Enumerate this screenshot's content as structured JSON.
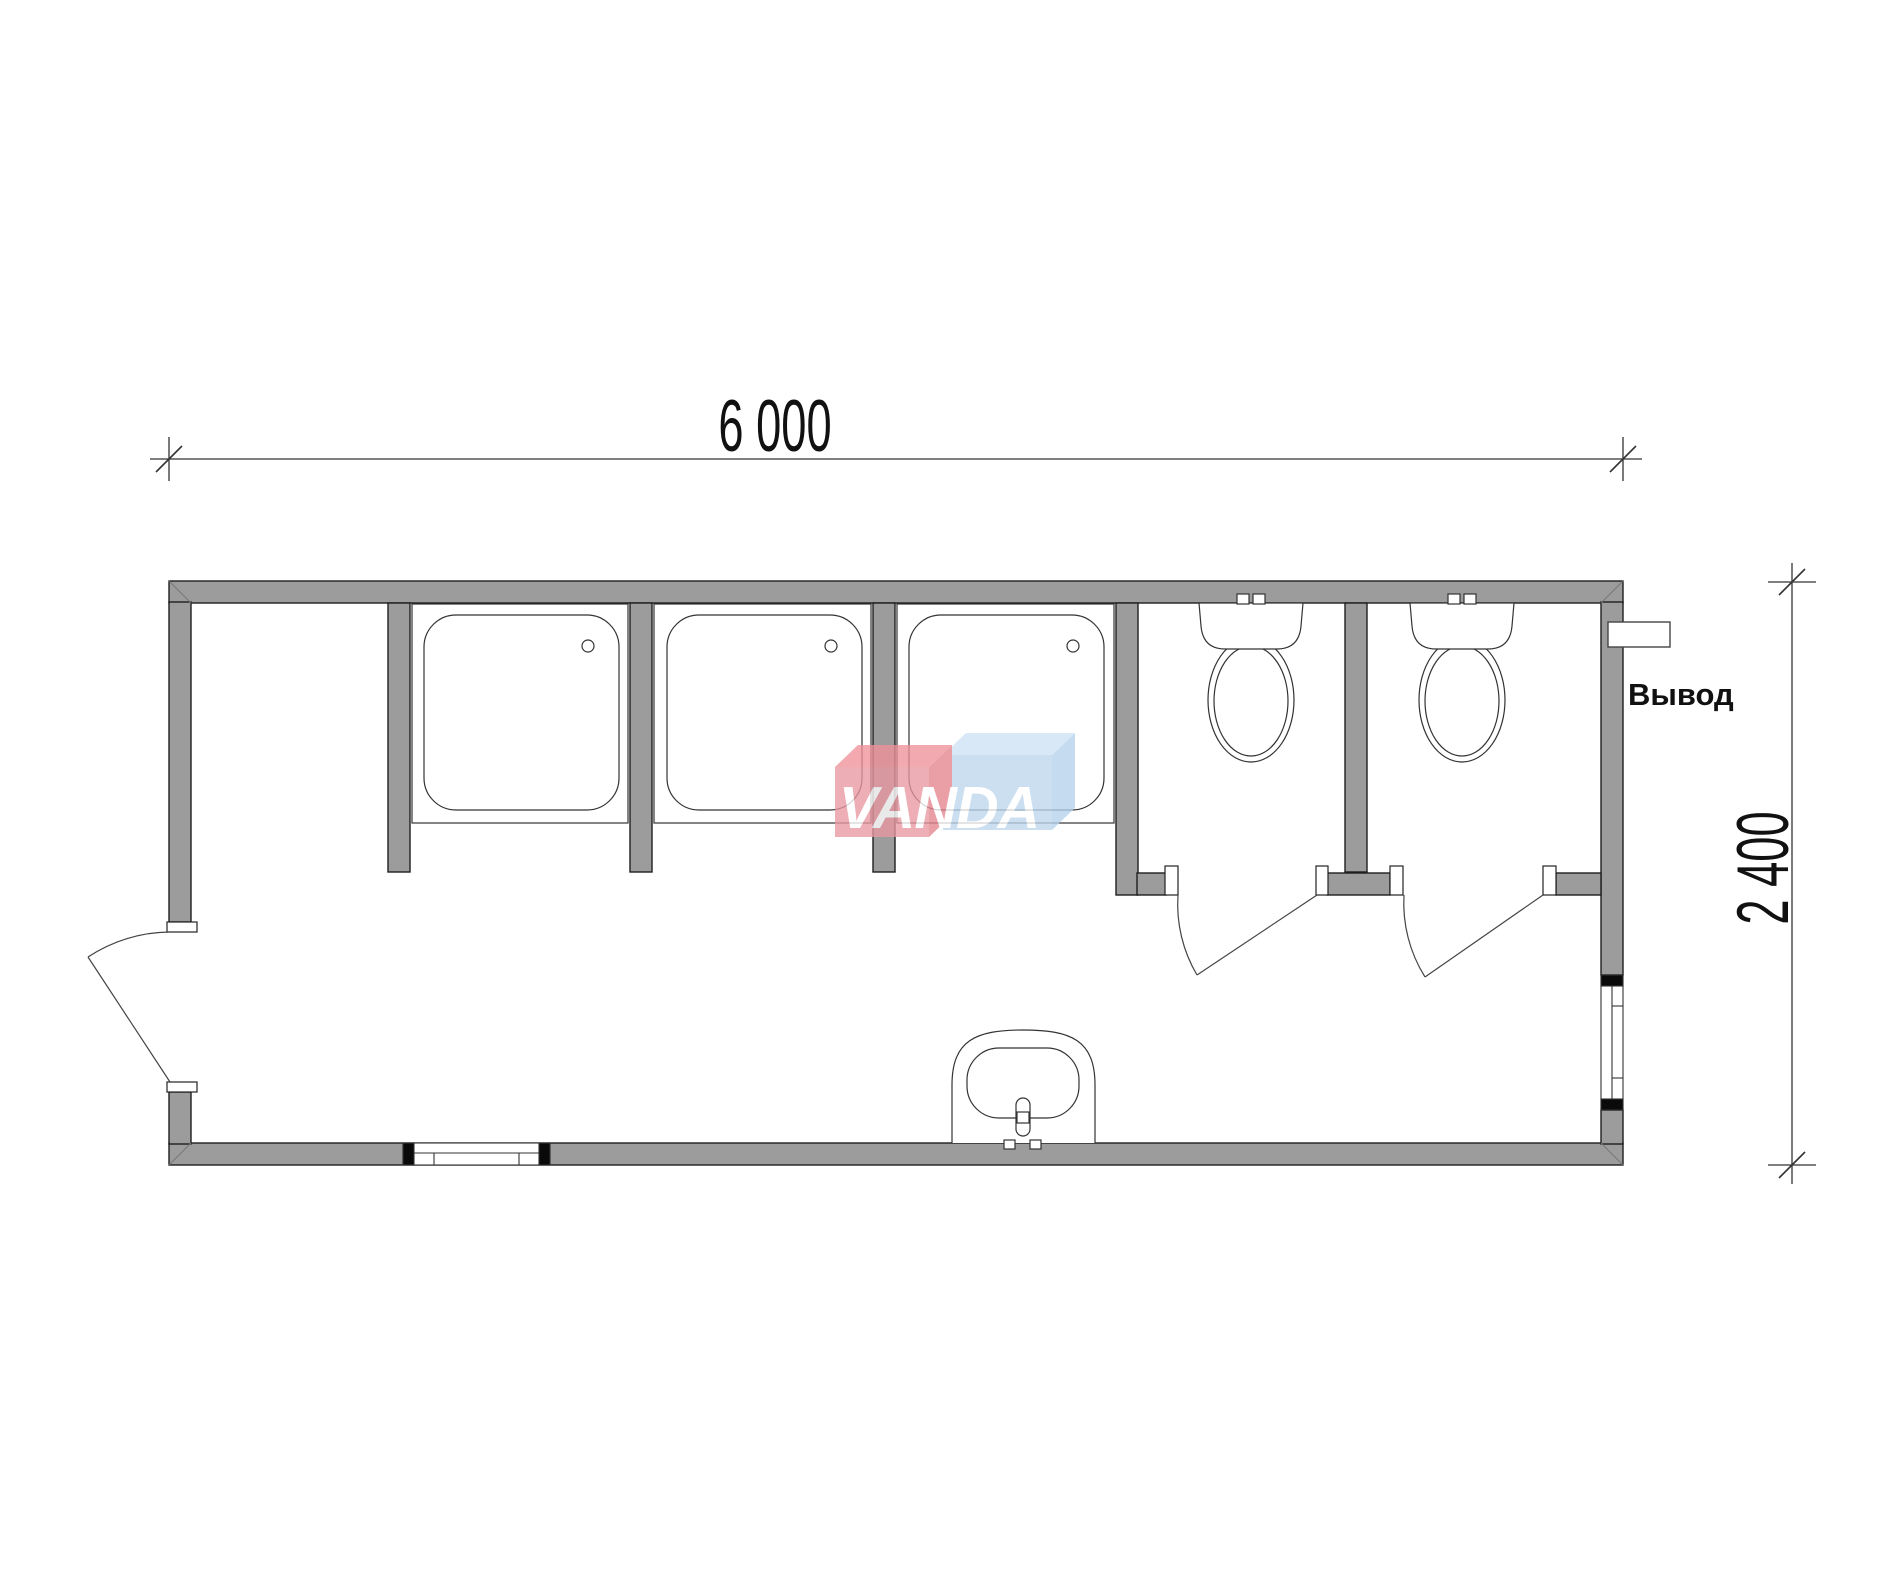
{
  "document": {
    "type": "floor-plan",
    "subject": "sanitary module plan with showers and toilets",
    "background": "#ffffff"
  },
  "dimensions": {
    "width_label": "6 000",
    "height_label": "2 400"
  },
  "labels": {
    "outlet": "Вывод"
  },
  "watermark": {
    "text": "VANDA",
    "red_front": "#ea98a1",
    "red_top": "#ef9199",
    "red_side": "#e5848e",
    "blue_front": "#bdd7ee",
    "blue_top": "#cfe2f4",
    "blue_side": "#b5d2ec"
  },
  "colors": {
    "wall_fill": "#9c9c9c",
    "plan_line": "#333333",
    "dim_line": "#333333",
    "window_cap": "#0a0a0a"
  },
  "fixtures": {
    "shower_tray_count": "3",
    "toilet_count": "2",
    "sink_count": "1",
    "door_count": "3",
    "window_count": "2"
  }
}
